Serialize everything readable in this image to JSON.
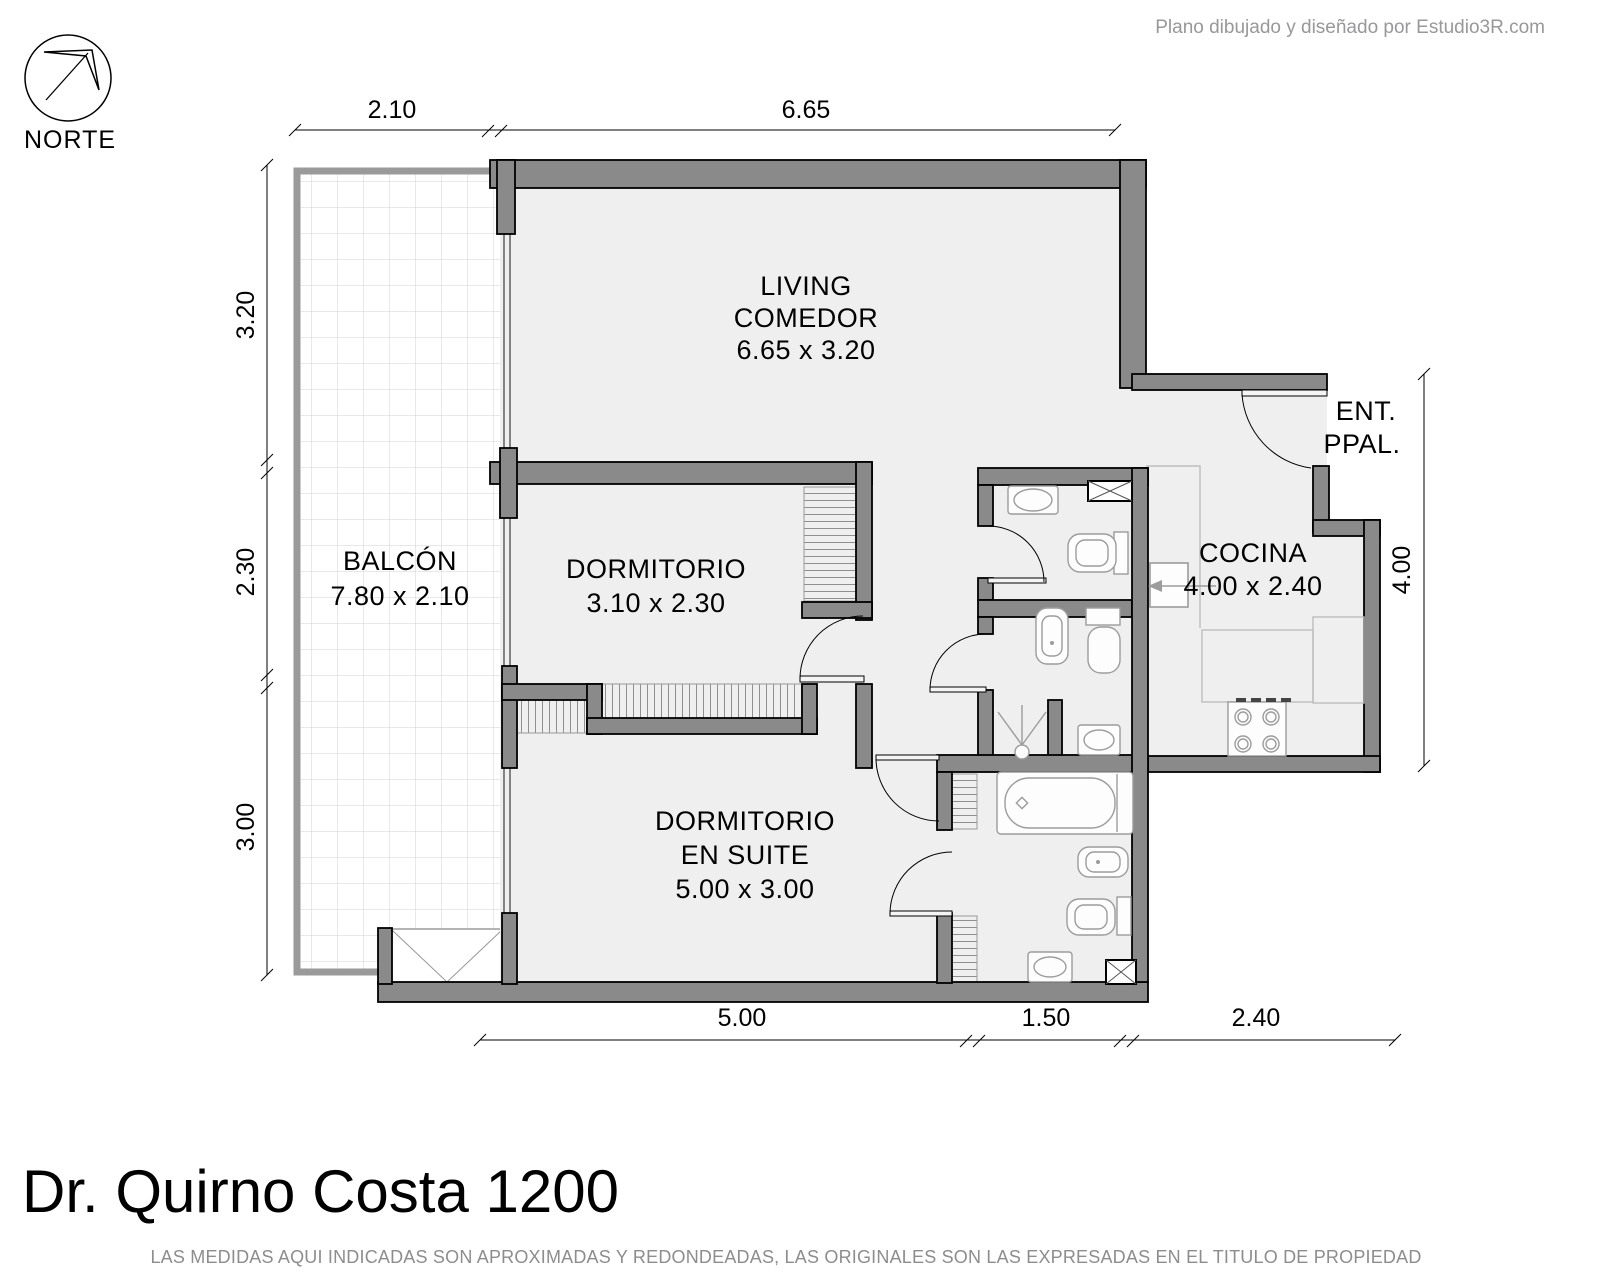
{
  "credit": "Plano dibujado y diseñado por Estudio3R.com",
  "compass_label": "NORTE",
  "title": "Dr. Quirno Costa 1200",
  "disclaimer": "LAS MEDIDAS AQUI INDICADAS SON APROXIMADAS Y REDONDEADAS, LAS ORIGINALES SON LAS EXPRESADAS EN EL TITULO DE PROPIEDAD",
  "rooms": {
    "living": {
      "name_line1": "LIVING",
      "name_line2": "COMEDOR",
      "size": "6.65 x 3.20"
    },
    "balcony": {
      "name": "BALCÓN",
      "size": "7.80 x 2.10"
    },
    "bedroom": {
      "name": "DORMITORIO",
      "size": "3.10 x 2.30"
    },
    "master": {
      "name_line1": "DORMITORIO",
      "name_line2": "EN SUITE",
      "size": "5.00 x 3.00"
    },
    "kitchen": {
      "name": "COCINA",
      "size": "4.00 x 2.40"
    },
    "entrance": {
      "name_line1": "ENT.",
      "name_line2": "PPAL."
    }
  },
  "dimensions": {
    "top": [
      "2.10",
      "6.65"
    ],
    "left": [
      "3.20",
      "2.30",
      "3.00"
    ],
    "right": [
      "4.00"
    ],
    "bottom": [
      "5.00",
      "1.50",
      "2.40"
    ]
  },
  "colors": {
    "wall": "#8a8a8a",
    "floor": "#efefef",
    "fixture_outline": "#9c9c9c",
    "muted_text": "#8d8d8d"
  }
}
